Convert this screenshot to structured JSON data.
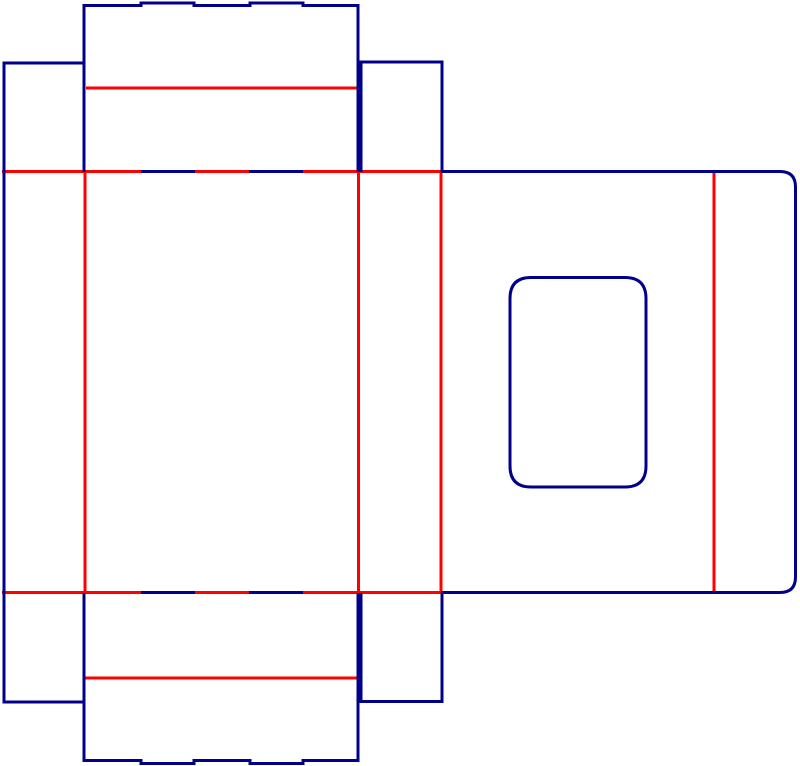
{
  "canvas": {
    "width": 800,
    "height": 766,
    "background_color": "#ffffff"
  },
  "diagram": {
    "type": "packaging-dieline",
    "stroke_width": 3,
    "colors": {
      "cut": "#00008B",
      "crease": "#FF0000"
    },
    "shapes": [
      {
        "id": "top-horizontal-crease",
        "role": "crease",
        "path": "M 2 171.5 L 441 171.5"
      },
      {
        "id": "bottom-horizontal-crease",
        "role": "crease",
        "path": "M 2 592.5 L 441 592.5"
      },
      {
        "id": "top-lid-crease",
        "role": "crease",
        "path": "M 86 88 L 358 88"
      },
      {
        "id": "bottom-lid-crease",
        "role": "crease",
        "path": "M 85 678 L 358 678"
      },
      {
        "id": "main-left-vertical-crease",
        "role": "crease",
        "path": "M 85 172 L 85 593"
      },
      {
        "id": "main-right-vertical-crease",
        "role": "crease",
        "path": "M 358.5 172 L 358.5 593"
      },
      {
        "id": "lid-attach-vertical-crease",
        "role": "crease",
        "path": "M 441 172 L 441 593"
      },
      {
        "id": "lid-inner-vertical-crease",
        "role": "crease",
        "path": "M 714 171.5 L 714 593"
      },
      {
        "id": "top-flap-outline",
        "role": "cut",
        "path": "M 84 172 L 84 5.5 L 141 5.5 L 141 3 L 194 3 L 194 5.5 L 250 5.5 L 250 3 L 303 3 L 303 5.5 L 358 5.5 L 358 172"
      },
      {
        "id": "left-glue-flap-outline",
        "role": "cut",
        "path": "M 85 63 L 4 63 L 4 702 L 85 702"
      },
      {
        "id": "top-right-flap-outline",
        "role": "cut",
        "path": "M 361 172 L 361 62 L 442 62 L 442 172"
      },
      {
        "id": "right-panel-outline",
        "role": "cut",
        "path": "M 441 171.5 L 780 171.5 Q 795.5 171.5 795.5 187 L 795.5 577 Q 795.5 592.5 780 592.5 L 441 592.5"
      },
      {
        "id": "window-cutout",
        "role": "cut",
        "path": "M 531 277.5 L 625 277.5 Q 646 277.5 646 298.5 L 646 466 Q 646 487 625 487 L 531 487 Q 510 487 510 466 L 510 298.5 Q 510 277.5 531 277.5 Z"
      },
      {
        "id": "bottom-right-flap-outline",
        "role": "cut",
        "path": "M 361 593 L 361 701.5 L 442 701.5 L 442 593"
      },
      {
        "id": "bottom-flap-outline",
        "role": "cut",
        "path": "M 84 593 L 84 760.5 L 141 760.5 L 141 763.5 L 194 763.5 L 194 760.5 L 250 760.5 L 250 763.5 L 303 763.5 L 303 760.5 L 358 760.5 L 358 593"
      },
      {
        "id": "top-crease-cut-dash-left",
        "role": "cut",
        "path": "M 141 171.5 L 195 171.5"
      },
      {
        "id": "top-crease-cut-dash-right",
        "role": "cut",
        "path": "M 249 171.5 L 303 171.5"
      },
      {
        "id": "bottom-crease-cut-dash-left",
        "role": "cut",
        "path": "M 141 592.5 L 195 592.5"
      },
      {
        "id": "bottom-crease-cut-dash-right",
        "role": "cut",
        "path": "M 249 592.5 L 303 592.5"
      }
    ]
  }
}
